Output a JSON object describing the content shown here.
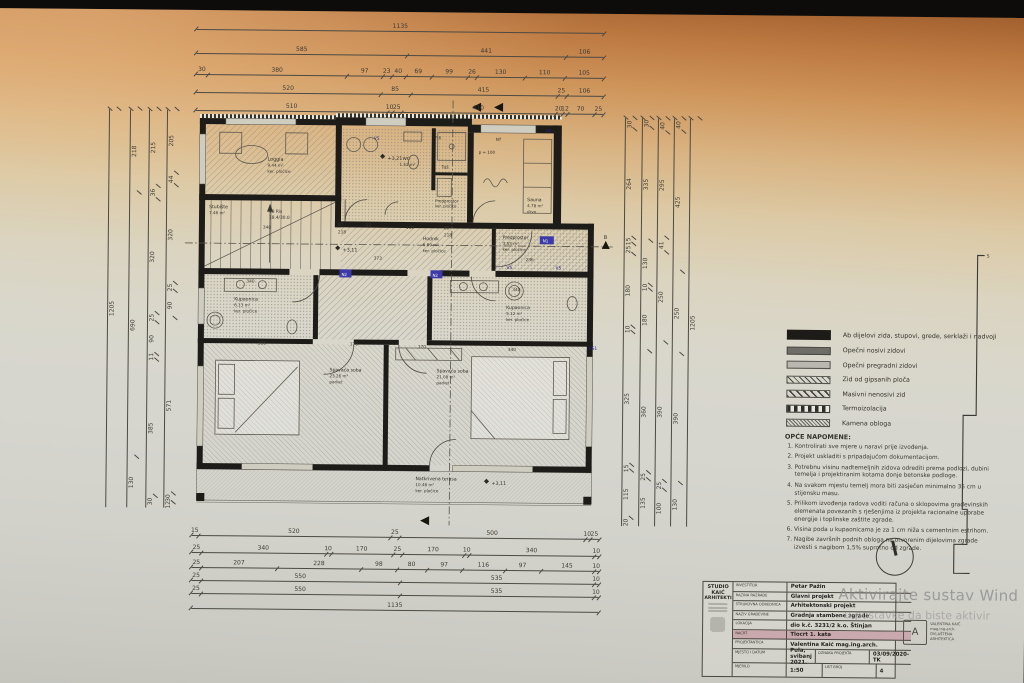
{
  "watermark": {
    "line1": "Aktivirajte sustav Wind",
    "line2": "u postavke da biste aktivir"
  },
  "colors": {
    "nacrt_highlight": "#c9a9ad"
  },
  "plan": {
    "rooms": {
      "loggia": {
        "name": "Loggia",
        "area": "9.44 m²",
        "floor": "ker. pločice"
      },
      "stubiste": {
        "name": "Stubište",
        "area": "7.48 m²"
      },
      "wc": {
        "name": "WC",
        "area": "1.52 m²"
      },
      "tus": {
        "name": "Tuš"
      },
      "predprostor1": {
        "name": "Predprostor",
        "floor": "ker. pločice"
      },
      "sauna": {
        "name": "Sauna",
        "area": "4.78 m²",
        "floor": "drvo"
      },
      "hodnik": {
        "name": "Hodnik",
        "area": "6.89 m²",
        "floor": "ker. pločice"
      },
      "predprostor2": {
        "name": "Predprostor",
        "area": "3.53 m²",
        "floor": "ker. pločice"
      },
      "kupaonica_l": {
        "name": "Kupaonica",
        "area": "6.13 m²",
        "floor": "ker. pločice"
      },
      "kupaonica_r": {
        "name": "Kupaonica",
        "area": "5.12 m²",
        "floor": "ker. pločice"
      },
      "spavaca_l": {
        "name": "Spavaća soba",
        "area": "23.26 m²",
        "floor": "parket"
      },
      "spavaca_r": {
        "name": "Spavaća soba",
        "area": "21.08 m²",
        "floor": "parket"
      },
      "terasa": {
        "name": "Natkrivena terasa",
        "area": "10.48 m²",
        "floor": "ker. pločice"
      }
    },
    "marks": {
      "elev_321": "+3,21",
      "elev_311a": "+3,11",
      "elev_311b": "+3,11",
      "stair1": "18 Ris",
      "stair2": "18.4/30.0",
      "v5": "V5",
      "v8": "V8",
      "n1": "N1",
      "n2": "N2",
      "vs1": "VS1",
      "fix": "FIX",
      "nt": "NT",
      "p100": "p = 100",
      "section_b": "B",
      "s": "S"
    },
    "inner_dims": {
      "i1": "340",
      "i2": "340",
      "i3": "390",
      "i4": "170",
      "i5": "170",
      "i6": "340",
      "i7": "373",
      "i8": "236",
      "i9": "110",
      "i10": "80",
      "i11": "97",
      "i12": "83",
      "i13": "218",
      "i14": "218",
      "i15": "340"
    }
  },
  "dimensions": {
    "top": [
      [
        "1135"
      ],
      [
        "585",
        "441",
        "106"
      ],
      [
        "30",
        "380",
        "97",
        "23",
        "40",
        "69",
        "99",
        "26",
        "130",
        "110",
        "105"
      ],
      [
        "520",
        "85",
        "415",
        "25",
        "106"
      ],
      [
        "510",
        "10",
        "25",
        "410",
        "20",
        "12",
        "70",
        "25"
      ]
    ],
    "bottom": [
      [
        "15",
        "520",
        "25",
        "500",
        "10",
        "25"
      ],
      [
        "25",
        "340",
        "10",
        "170",
        "25",
        "170",
        "10",
        "340",
        "10"
      ],
      [
        "25",
        "207",
        "228",
        "98",
        "80",
        "97",
        "116",
        "97",
        "145",
        "10"
      ],
      [
        "25",
        "550",
        "535",
        "10"
      ],
      [
        "25",
        "550",
        "535",
        "10"
      ],
      [
        "1135"
      ]
    ],
    "left": [
      [
        "1205"
      ],
      [
        "218",
        "690",
        "130"
      ],
      [
        "215",
        "36",
        "320",
        "25",
        "90",
        "11",
        "385",
        "30"
      ],
      [
        "205",
        "44",
        "320",
        "25",
        "90",
        "571",
        "30",
        "12"
      ]
    ],
    "right": [
      [
        "30",
        "264",
        "15",
        "25",
        "180",
        "10",
        "325",
        "15",
        "115",
        "20"
      ],
      [
        "30",
        "335",
        "130",
        "10",
        "180",
        "360",
        "25",
        "135"
      ],
      [
        "40",
        "295",
        "41",
        "250",
        "390",
        "25",
        "100"
      ],
      [
        "40",
        "425",
        "250",
        "390",
        "130"
      ],
      [
        "1205"
      ]
    ]
  },
  "legend": {
    "items": [
      {
        "label": "Ab dijelovi zida, stupovi, grede, serklaži i nadvoji",
        "swatch": "sw-solid"
      },
      {
        "label": "Opečni nosivi zidovi",
        "swatch": "sw-dark"
      },
      {
        "label": "Opečni pregradni zidovi",
        "swatch": "sw-light"
      },
      {
        "label": "Zid od gipsanih ploča",
        "swatch": "sw-hatch"
      },
      {
        "label": "Masivni nenosivi zid",
        "swatch": "sw-hatch2"
      },
      {
        "label": "Termoizolacija",
        "swatch": "sw-check"
      },
      {
        "label": "Kamena obloga",
        "swatch": "sw-hatch3"
      }
    ]
  },
  "notes": {
    "title": "OPĆE NAPOMENE:",
    "items": [
      "Kontrolirati sve mjere u naravi prije izvođenja.",
      "Projekt uskladiti s pripadajućom dokumentacijom.",
      "Potrebnu visinu nadtemeljnih zidova odrediti prema podlozi, dubini temelja i projektiranim kotama donje betonske podloge.",
      "Na svakom mjestu temelj mora biti zasječen minimalno 35 cm u stijensku masu.",
      "Prilikom izvođenja radova voditi računa o sklopovima građevinskih elemenata povezanih s rješenjima iz projekta racionalne uporabe energije i toplinske zaštite zgrade.",
      "Visina poda u kupaonicama je za 1 cm niža s cementnim estrihom.",
      "Nagibe završnih podnih obloga na otvorenim dijelovima zgrade izvesti s nagibom 1,5% suprotno od zgrade."
    ]
  },
  "titleblock": {
    "studio_line1": "STUDIO KAIĆ",
    "studio_line2": "ARHITEKTI",
    "rows": [
      {
        "label": "INVESTITOR",
        "value": "Petar Pažin"
      },
      {
        "label": "RAZINA RAZRADE",
        "value": "Glavni projekt"
      },
      {
        "label": "STRUKOVNA ODREDNICA",
        "value": "Arhitektonski projekt"
      },
      {
        "label": "NAZIV GRAĐEVINE",
        "value": "Gradnja stambene zgrade"
      },
      {
        "label": "LOKACIJA",
        "value": "dio k.č. 3231/2 k.o. Štinjan"
      },
      {
        "label": "NACRT",
        "value": "Tlocrt 1. kata",
        "hl": "hl"
      },
      {
        "label": "PROJEKTANTICA",
        "value": "Valentina Kaić mag.ing.arch."
      }
    ],
    "place_label": "MJESTO I DATUM",
    "place": "Pula, svibanj 2021.",
    "code_label": "OZNAKA PROJEKTA",
    "code": "03/09/2020-TK",
    "scale_label": "MJERILO",
    "scale": "1:50",
    "sheet_label": "LIST BROJ",
    "sheet": "4",
    "stamp": {
      "l1": "VALENTINA KAIĆ",
      "l2": "mag.ing.arch.",
      "l3": "OVLAŠTENA",
      "l4": "ARHITEKTICA"
    }
  }
}
